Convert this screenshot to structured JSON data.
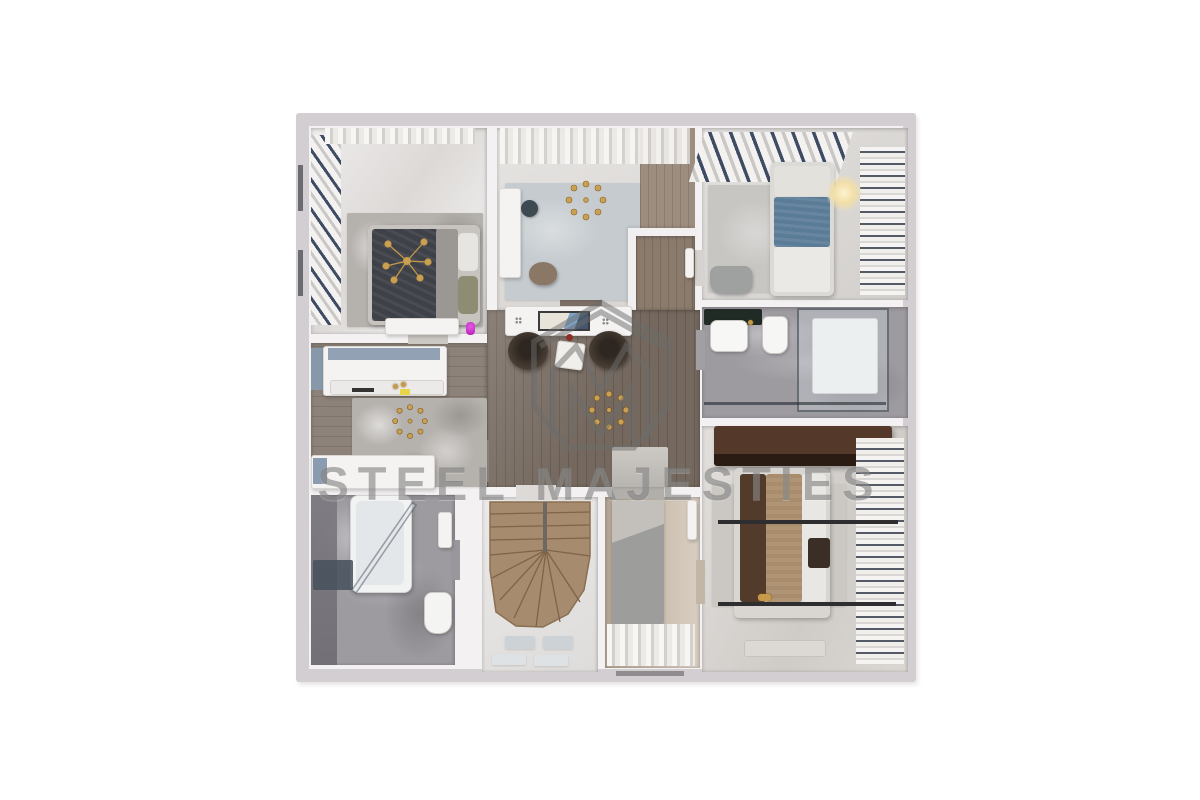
{
  "scene": {
    "kind": "3d-floor-plan-top-view-render",
    "background_color": "#ffffff"
  },
  "watermark": {
    "text": "STEEL MAJESTIES",
    "color": "#6c6c6c",
    "opacity": 0.52,
    "logo_icon": "house-m-monogram-icon"
  },
  "palette": {
    "outer_wall": "#d2ced1",
    "inner_wall": "#f3f1f2",
    "hall_wood": "#75695f",
    "dressing_wood": "#8c8279",
    "stair_wood": "#a68b6e",
    "corridor_floor": "#bdae9d",
    "marble": "#9d9aa0",
    "rug_gray": "#c4c1bc",
    "rug_blue_gray": "#c5cbcf",
    "bed_dark": "#3e4147",
    "bed_blue": "#5b7c97",
    "bed_tan": "#a98c6c",
    "wardrobe_brown": "#46311f",
    "pouf_brown": "#40372f",
    "accent_gold": "#c79a4b",
    "curtain_navy": "#35445e",
    "accent_magenta": "#d32fd6"
  }
}
